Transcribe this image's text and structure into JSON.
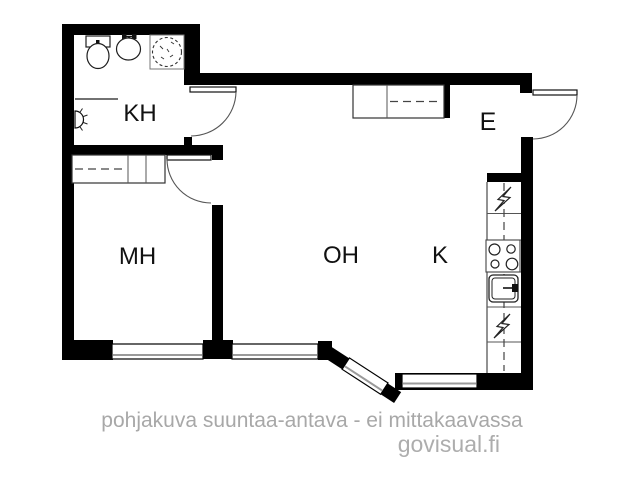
{
  "rooms": {
    "kh": {
      "label": "KH"
    },
    "mh": {
      "label": "MH"
    },
    "oh": {
      "label": "OH"
    },
    "k": {
      "label": "K"
    },
    "e": {
      "label": "E"
    }
  },
  "footer": {
    "disclaimer": "pohjakuva suuntaa-antava - ei mittakaavassa",
    "watermark": "govisual.fi"
  },
  "colors": {
    "wall": "#000000",
    "caption_gray": "#a8a8a8",
    "glazing_gray": "#9a9a9a",
    "background": "#ffffff"
  },
  "icons": [
    "toilet-icon",
    "washbasin-icon",
    "shower-icon",
    "wall-lamp-icon",
    "wardrobe-icon",
    "coat-closet-icon",
    "fridge-lightning-icon",
    "stove-icon",
    "kitchen-sink-icon",
    "dishwasher-lightning-icon",
    "door-swing-icon",
    "window-icon"
  ]
}
